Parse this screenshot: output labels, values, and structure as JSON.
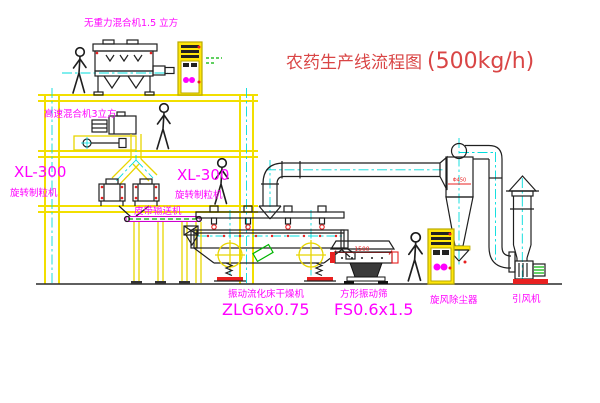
{
  "diagram": {
    "title": {
      "name": "农药生产线流程图",
      "capacity": "(500kg/h)"
    },
    "labels": {
      "gravity_mixer": "无重力混合机1.5 立方",
      "high_speed_mixer": "高速混合机3立方",
      "granulator_left_model": "XL-300",
      "granulator_left_name": "旋转制粒机",
      "granulator_center_model": "XL-300",
      "granulator_center_name": "旋转制粒机",
      "belt_conveyor": "皮带输送机",
      "dryer_name": "振动流化床干燥机",
      "dryer_model": "ZLG6x0.75",
      "sieve_name": "方形振动筛",
      "sieve_model": "FS0.6x1.5",
      "sieve_dimension": "1500",
      "cyclone_name": "旋风除尘器",
      "cyclone_dimension": "Φ450",
      "fan_name": "引风机"
    },
    "colors": {
      "background": "#ffffff",
      "structure_yellow": "#f2df00",
      "machine_outline": "#1f1f1f",
      "centerline_cyan": "#00dcdc",
      "label_magenta": "#ff00ff",
      "title_red": "#d94545",
      "accent_red": "#e82020",
      "accent_green": "#00b400"
    }
  }
}
